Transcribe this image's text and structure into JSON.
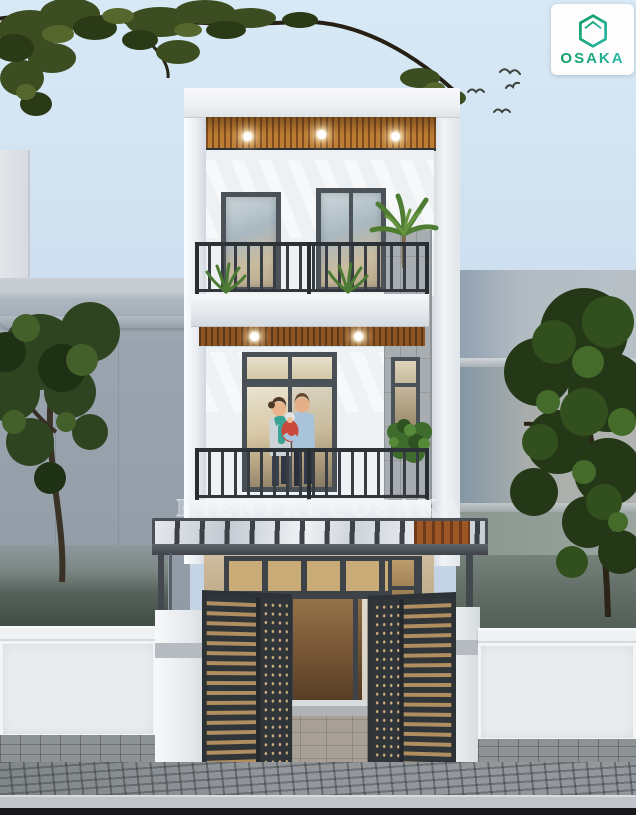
{
  "logo": {
    "brand": "OSAKA",
    "icon": "hexagon-house-icon"
  },
  "watermark": {
    "text": "KIENTRUCOSAKA"
  },
  "scene": {
    "type": "architectural exterior render",
    "subject": "modern three-storey townhouse facade at dusk",
    "colors": {
      "sky": "#cfe0ef",
      "facade_white": "#f2f4f6",
      "wood_accent": "#b9752f",
      "frame_dark": "#3d4348",
      "stone_gray": "#a8adb1",
      "foliage_green": "#33491f",
      "pavement_gray": "#92979c",
      "logo_green": "#0c9c60",
      "logo_teal": "#2cb8a8"
    },
    "elements": [
      "wood-slat ceilings with recessed downlights",
      "two balconies with dark metal railings",
      "couple holding baby on second-floor balcony",
      "glass pergola canopy over entry",
      "open slatted metal gates",
      "white boundary fence with pillars",
      "brick sidewalk and curb",
      "neighbouring gray buildings",
      "street trees and potted plants",
      "four flying birds"
    ]
  }
}
